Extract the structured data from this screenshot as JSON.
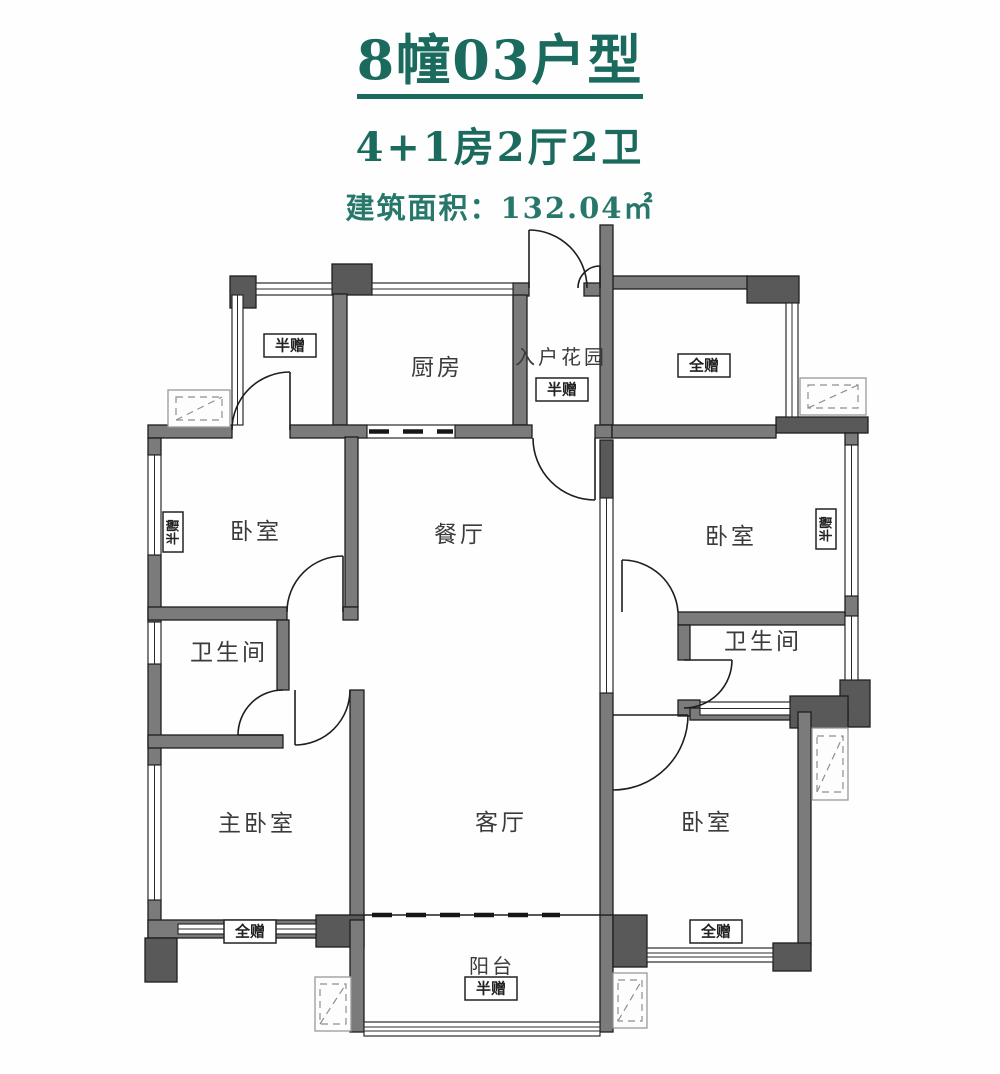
{
  "header": {
    "title": "8幢03户型",
    "subtitle": "4+1房2厅2卫",
    "area_label": "建筑面积：132.04㎡"
  },
  "floorplan": {
    "rooms": {
      "kitchen": "厨房",
      "entry_garden": "入户花园",
      "dining": "餐厅",
      "living": "客厅",
      "balcony": "阳台",
      "master_bedroom": "主卧室",
      "bedroom_top_left": "卧室",
      "bedroom_top_right": "卧室",
      "bedroom_bottom_right": "卧室",
      "bathroom_left": "卫生间",
      "bathroom_right": "卫生间"
    },
    "tags": {
      "half_gift": "半赠",
      "full_gift": "全赠"
    },
    "colors": {
      "title_teal": "#1b6a5e",
      "area_teal": "#27786b",
      "wall_gray": "#7b7b7b",
      "wall_dark": "#595959",
      "line_black": "#1e1e1e",
      "label_gray": "#3b3b3b"
    }
  }
}
